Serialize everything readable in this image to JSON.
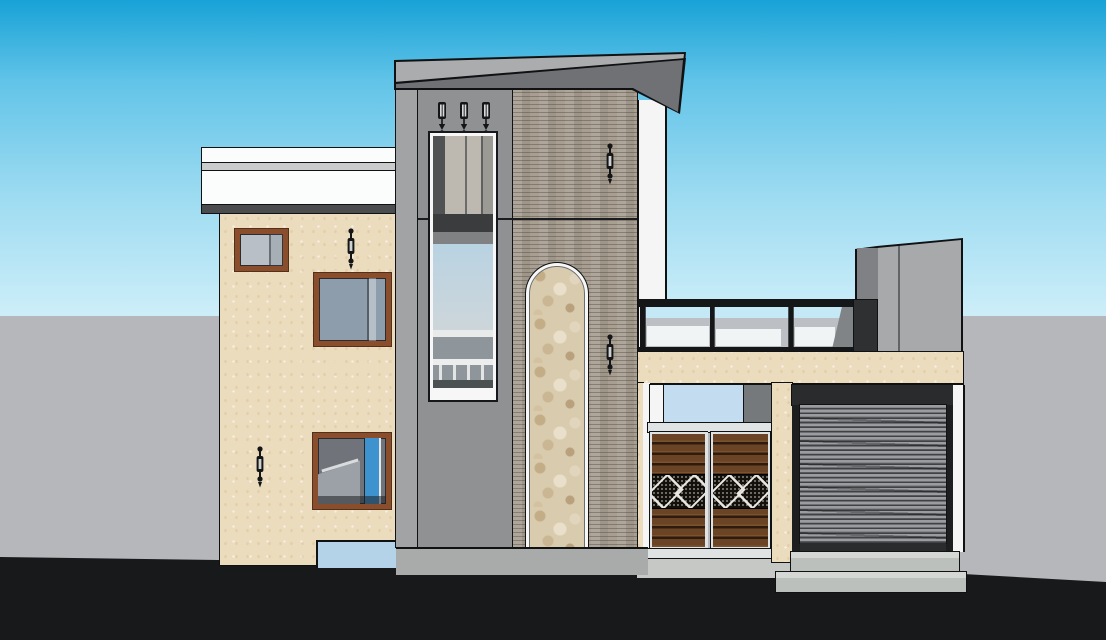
{
  "meta": {
    "title": "3D elevation render of a modern two-storey house (SketchUp style)",
    "canvas": {
      "width": 1106,
      "height": 640
    }
  },
  "scene": {
    "background": {
      "sky_label": "clear gradient sky",
      "horizon_label": "flat grey ground plane",
      "foreground_label": "dark asphalt foreground strip"
    },
    "left_house": {
      "label": "cream two-storey house block with white parapet cornice",
      "parapet_label": "stepped white parapet cornice",
      "windows": [
        {
          "label": "small upper window, brown frame"
        },
        {
          "label": "square upper window, brown frame"
        },
        {
          "label": "lower stair window, brown frame, blue interior wall visible"
        }
      ],
      "sconces": 2,
      "lower_opening_label": "light blue ground-floor opening"
    },
    "tower": {
      "label": "central stair tower with grey facade panel and flat roof slab",
      "roof_label": "grey cantilevered roof slab",
      "downlights": 3,
      "window_label": "full-height stair window with louvre top, glazing and interior railing",
      "brick_pier_label": "textured brick-tile pier",
      "stone_arch_label": "arched rubble-stone feature panel with white trim",
      "sconces": 2,
      "plinth_label": "grey plinth / base strip"
    },
    "right_wing": {
      "label": "single-storey wing with roof terrace",
      "back_wall_label": "white stair bulkhead wall",
      "railing_label": "black-framed glass terrace railing",
      "rooftop_box_label": "grey rooftop tank / bulkhead box",
      "fascia_label": "cream fascia band",
      "transom_label": "glazed transom over gate",
      "gate_label": "double wooden entrance gate with diamond lattice band",
      "gate_leaves": 2,
      "garage_label": "roller-shutter garage door",
      "steps": 2
    }
  },
  "colors": {
    "sky_top": "#18a2d7",
    "sky_mid": "#62c4e8",
    "sky_low": "#cdeef9",
    "horizon_gray": "#b5b7ba",
    "ground_dark": "#18191b",
    "stucco": "#ecdcbe",
    "parapet_white": "#fbfcfc",
    "parapet_ledge": "#c9cbcd",
    "parapet_shadow": "#4b4c4e",
    "frame_brown": "#8a4e2c",
    "frame_brown_dark": "#53301a",
    "glass_gray": "#b8bfc6",
    "glass_slate": "#8e9dab",
    "glass_blue": "#3e93cf",
    "interior_gray": "#70747a",
    "interior_light": "#9ba1a6",
    "tower_front": "#8f9193",
    "tower_side": "#a2a3a5",
    "roof_top": "#aaacae",
    "roof_under": "#707174",
    "brick": "#a89f92",
    "stone": "#d9cbae",
    "trim_white": "#f6f7f6",
    "fixture_black": "#141516",
    "louver": "#bdb9b1",
    "louver_dark": "#505254",
    "slab_dark": "#3b3c3e",
    "ledge_gray": "#7f8183",
    "glass_sky_top": "#b9d3e2",
    "glass_sky_bot": "#cdd6da",
    "sill_white": "#e9ebeb",
    "lower_glass": "#8e969c",
    "lower_dark": "#4b5053",
    "rail_black": "#151617",
    "back_wall_white": "#f4f5f4",
    "corner_dark": "#2f3032",
    "shadow_slant": "#6f7174",
    "transom_blue": "#c3dcef",
    "transom_gray": "#75797c",
    "gate_metal": "#dfe3e4",
    "wood": "#6b4426",
    "wood_mid": "#7a5230",
    "wood_dark": "#2e1b0d",
    "ornament_dark": "#131009",
    "housing_dark": "#2a2b2d",
    "channel_dark": "#1d1e20",
    "slat_light": "#9a9c9f",
    "slat_mid": "#6d6f72",
    "slat_dark": "#3f4144",
    "step_top": "#d4d7d3",
    "step_face": "#bcc0bc",
    "box_front": "#a7a9ab",
    "box_side": "#7f8184",
    "walkway": "#c5c8c5",
    "plinth": "#a9abab",
    "opening_blue": "#b4d3e9",
    "edge_black": "#101113"
  }
}
